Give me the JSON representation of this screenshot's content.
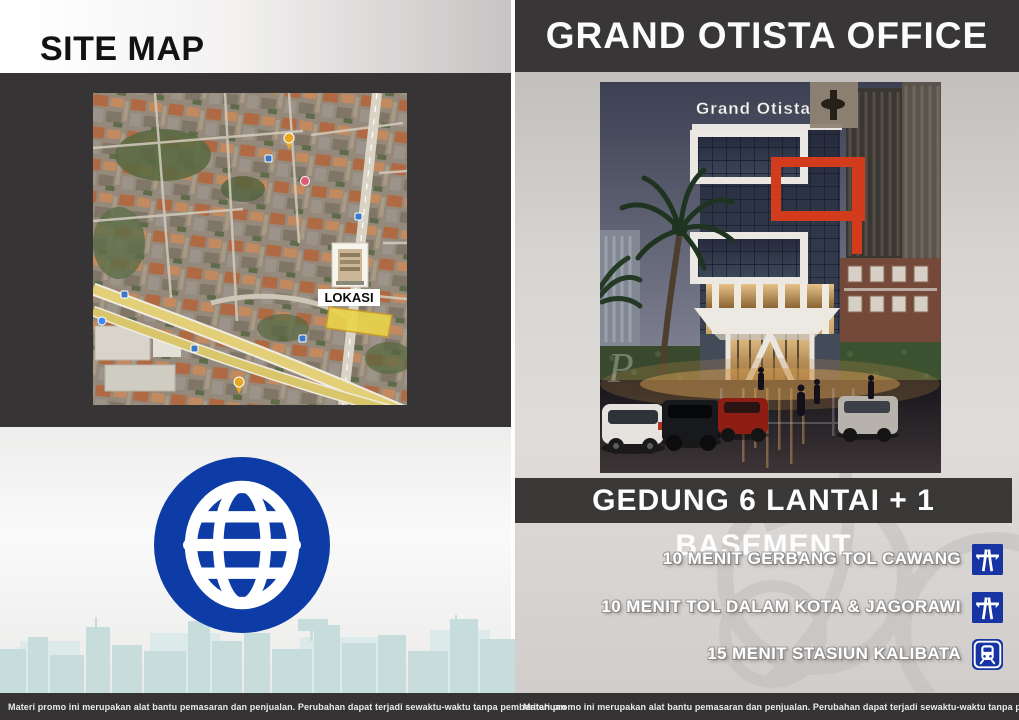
{
  "left_panel": {
    "title": "SITE MAP",
    "map": {
      "name": "satellite-site-map",
      "location_label": "LOKASI"
    },
    "disclaimer": "Materi promo ini merupakan alat bantu pemasaran dan penjualan. Perubahan dapat terjadi sewaktu-waktu tanpa pemberitahuan"
  },
  "right_panel": {
    "title": "GRAND OTISTA OFFICE",
    "building": {
      "sign": "Grand Otista",
      "watermark": "P"
    },
    "banner": "GEDUNG 6 LANTAI + 1 BASEMENT",
    "features": [
      {
        "label": "10 MENIT GERBANG TOL CAWANG",
        "icon": "motorway-icon"
      },
      {
        "label": "10 MENIT TOL DALAM KOTA & JAGORAWI",
        "icon": "motorway-icon"
      },
      {
        "label": "15 MENIT STASIUN KALIBATA",
        "icon": "train-icon"
      }
    ],
    "disclaimer": "Materi promo ini merupakan alat bantu pemasaran dan penjualan. Perubahan dapat terjadi sewaktu-waktu tanpa pemberitahuan"
  },
  "icons": {
    "globe": "globe-icon",
    "feature_icons": [
      "motorway-icon",
      "motorway-icon",
      "train-icon"
    ]
  },
  "colors": {
    "panel_dark": "#363435",
    "header_dark": "#393637",
    "icon_blue": "#1735a2",
    "globe_blue": "#0d3ca6",
    "accent_red": "#d23c1d",
    "skyline_teal": "#c6dddc",
    "map_plot_yellow": "#e9d44b"
  }
}
